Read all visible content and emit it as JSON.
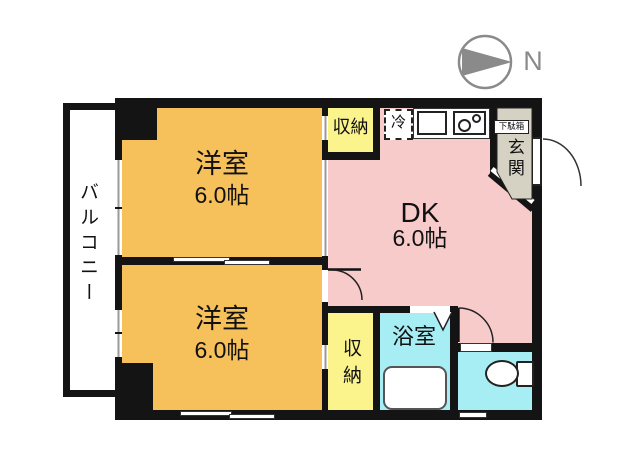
{
  "compass": {
    "north_label": "N"
  },
  "balcony": {
    "label": "バルコニー"
  },
  "rooms": {
    "western_top": {
      "name": "洋室",
      "size": "6.0帖"
    },
    "western_bottom": {
      "name": "洋室",
      "size": "6.0帖"
    },
    "dining_kitchen": {
      "name": "DK",
      "size": "6.0帖"
    },
    "closet_top": {
      "label": "収納"
    },
    "closet_bottom": {
      "label": "収納"
    },
    "bathroom": {
      "label": "浴室"
    },
    "entrance": {
      "label": "玄関"
    },
    "shoe_box": {
      "label": "下駄箱"
    },
    "refrigerator": {
      "label": "冷"
    }
  },
  "colors": {
    "room-orange": "#f6c05a",
    "dk-pink": "#f8cbcb",
    "closet-yellow": "#fbf38c",
    "wet-cyan": "#a6eef3",
    "entrance-gray": "#d5d2c3",
    "wall-black": "#141414",
    "compass-gray": "#8a8a8a"
  }
}
